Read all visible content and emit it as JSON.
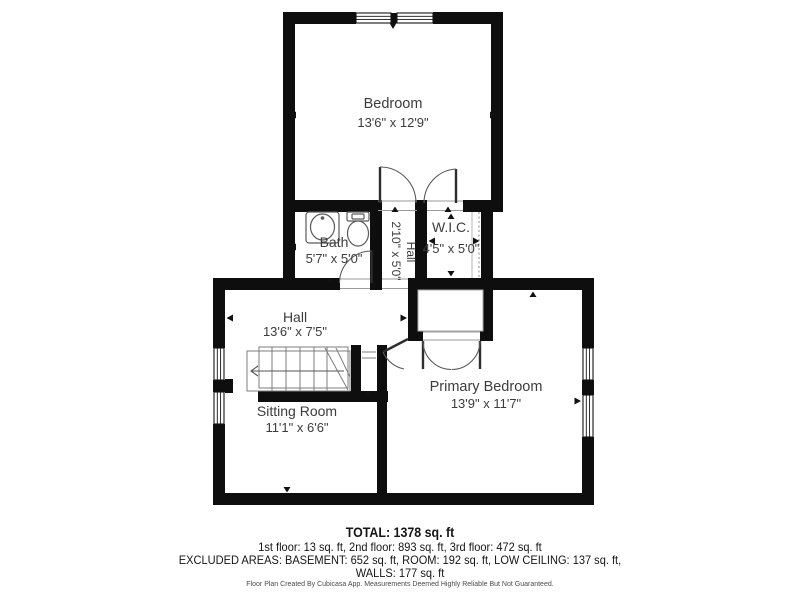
{
  "colors": {
    "wall": "#0e0e0e",
    "room_fill": "#ffffff",
    "thin_line": "#5a5a5a",
    "label": "#3c3c3c",
    "summary_text": "#151515",
    "disclaimer_text": "#4a4a4a"
  },
  "rooms": {
    "bedroom": {
      "name": "Bedroom",
      "dims": "13'6\" x 12'9\""
    },
    "bath": {
      "name": "Bath",
      "dims": "5'7\" x 5'0\""
    },
    "hall_upper": {
      "name": "Hall",
      "dims": "2'10\" x 5'0\""
    },
    "wic": {
      "name": "W.I.C.",
      "dims": "4'5\" x 5'0\""
    },
    "hall": {
      "name": "Hall",
      "dims": "13'6\" x 7'5\""
    },
    "sitting_room": {
      "name": "Sitting Room",
      "dims": "11'1\" x 6'6\""
    },
    "primary_bedroom": {
      "name": "Primary Bedroom",
      "dims": "13'9\" x 11'7\""
    }
  },
  "summary": {
    "total": "TOTAL: 1378 sq. ft",
    "floors": "1st floor: 13 sq. ft, 2nd floor: 893 sq. ft, 3rd floor: 472 sq. ft",
    "excluded_line1": "EXCLUDED AREAS: BASEMENT: 652 sq. ft, ROOM: 192 sq. ft, LOW CEILING: 137 sq. ft,",
    "excluded_line2": "WALLS: 177 sq. ft"
  },
  "footer": {
    "disclaimer": "Floor Plan Created By Cubicasa App. Measurements Deemed Highly Reliable But Not Guaranteed."
  }
}
